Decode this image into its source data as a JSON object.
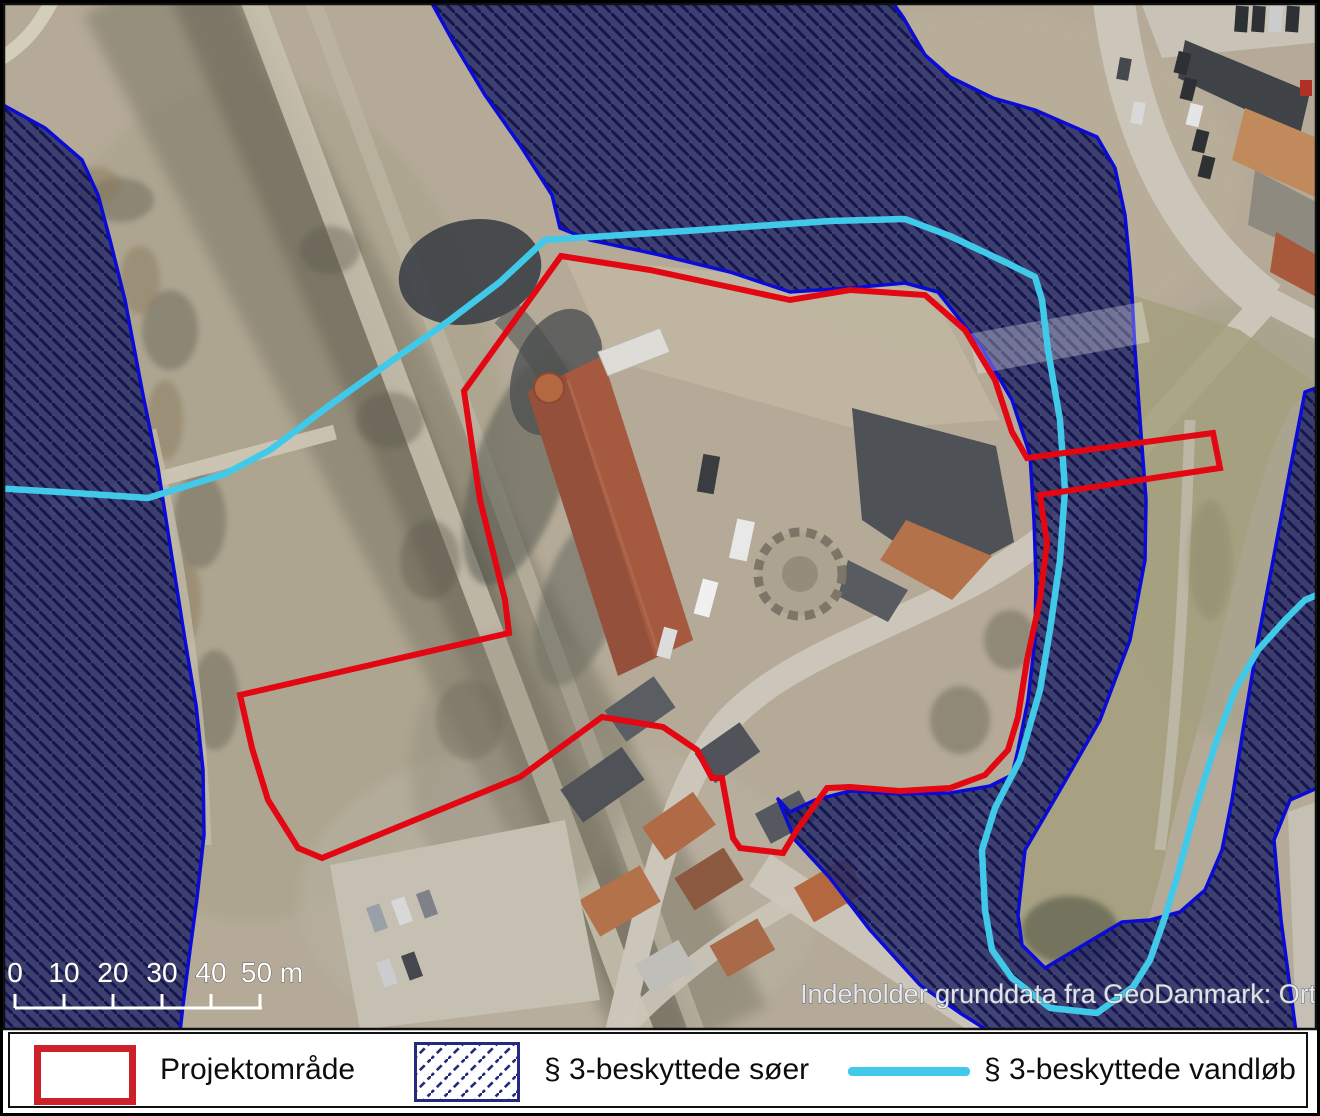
{
  "map": {
    "scale_bar": {
      "labels": [
        "0",
        "10",
        "20",
        "30",
        "40",
        "50 m"
      ]
    },
    "attribution": "Indeholder grunddata fra GeoDanmark: Ortofoto forår"
  },
  "legend": {
    "items": [
      {
        "id": "project-area",
        "label": "Projektområde"
      },
      {
        "id": "protected-lakes",
        "label": "§ 3-beskyttede søer"
      },
      {
        "id": "protected-streams",
        "label": "§ 3-beskyttede vandløb"
      }
    ]
  },
  "colors": {
    "project_area_red": "#e30613",
    "lake_fill_navy": "#262b66",
    "lake_border_blue": "#0b0bd6",
    "hatch_line_navy": "#151552",
    "stream_cyan": "#41c9e9",
    "legend_red": "#cc2128",
    "legend_navy": "#252a7e"
  }
}
